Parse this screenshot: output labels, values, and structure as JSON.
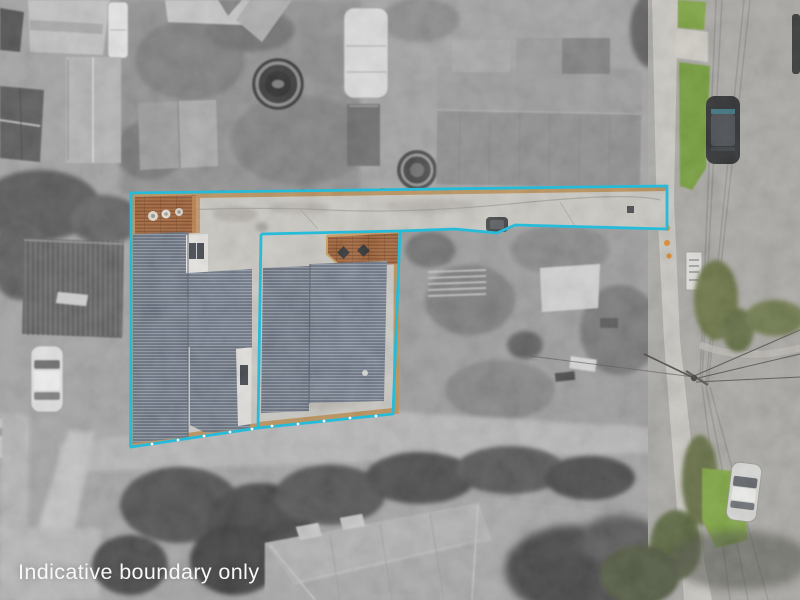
{
  "caption": {
    "text": "Indicative boundary only"
  },
  "overlay": {
    "boundary_line": "cyan solid polygon outlining two lots and rear access strip"
  },
  "colors": {
    "photo_base": "#a4a4a4",
    "caption": "#f7f7f7",
    "boundary": "#27bbda",
    "roof": "#6b7484",
    "roof2": "#707a8a",
    "deck": "#9c5c31",
    "deck_light": "#c0854d",
    "wood_fence": "#b98f58",
    "concrete": "#d0cec8",
    "strip_concrete": "#c9c7c1",
    "grass": "#7aa23a",
    "grass2": "#6f9a35",
    "hedge_olive": "#657040",
    "road": "#a8a6a2",
    "footpath": "#c9c6c0",
    "car_dark": "#26282b",
    "car_silver": "#d8d8d5",
    "orange_marker": "#e08a28",
    "white_roof": "#e4e2de"
  }
}
